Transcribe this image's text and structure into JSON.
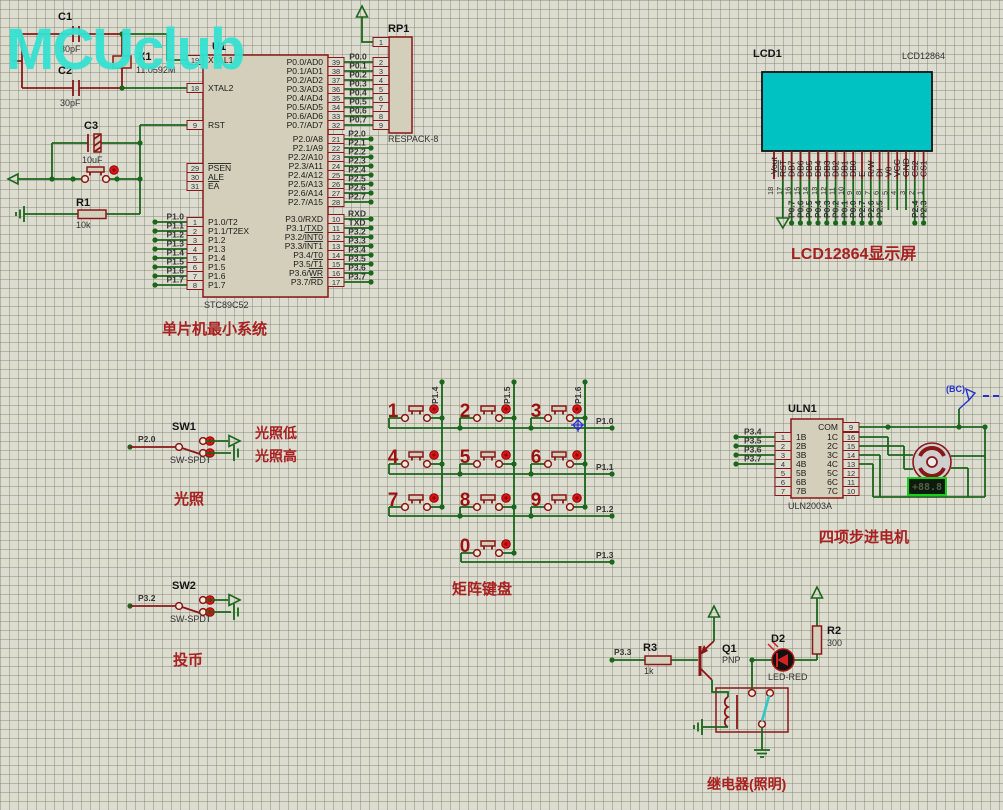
{
  "watermark": "MCUclub",
  "titles": {
    "mcu": "单片机最小系统",
    "lcd": "LCD12864显示屏",
    "keypad": "矩阵键盘",
    "stepper": "四项步进电机",
    "light": "光照",
    "light_low": "光照低",
    "light_high": "光照高",
    "coin": "投币",
    "relay": "继电器(照明)"
  },
  "mcu": {
    "ref": "U1",
    "part": "STC89C52",
    "ctrl_pins": [
      {
        "num": "19",
        "name": "XTAL1"
      },
      {
        "num": "18",
        "name": "XTAL2"
      },
      {
        "num": "9",
        "name": "RST"
      },
      {
        "num": "29",
        "name": "|PSEN"
      },
      {
        "num": "30",
        "name": "ALE"
      },
      {
        "num": "31",
        "name": "|EA"
      }
    ],
    "p1_pins": [
      {
        "num": "1",
        "name": "P1.0/T2",
        "net": "P1.0"
      },
      {
        "num": "2",
        "name": "P1.1/T2EX",
        "net": "P1.1"
      },
      {
        "num": "3",
        "name": "P1.2",
        "net": "P1.2"
      },
      {
        "num": "4",
        "name": "P1.3",
        "net": "P1.3"
      },
      {
        "num": "5",
        "name": "P1.4",
        "net": "P1.4"
      },
      {
        "num": "6",
        "name": "P1.5",
        "net": "P1.5"
      },
      {
        "num": "7",
        "name": "P1.6",
        "net": "P1.6"
      },
      {
        "num": "8",
        "name": "P1.7",
        "net": "P1.7"
      }
    ],
    "p0_pins": [
      {
        "num": "39",
        "name": "P0.0/AD0",
        "net": "P0.0",
        "rp": "2"
      },
      {
        "num": "38",
        "name": "P0.1/AD1",
        "net": "P0.1",
        "rp": "3"
      },
      {
        "num": "37",
        "name": "P0.2/AD2",
        "net": "P0.2",
        "rp": "4"
      },
      {
        "num": "36",
        "name": "P0.3/AD3",
        "net": "P0.3",
        "rp": "5"
      },
      {
        "num": "35",
        "name": "P0.4/AD4",
        "net": "P0.4",
        "rp": "6"
      },
      {
        "num": "34",
        "name": "P0.5/AD5",
        "net": "P0.5",
        "rp": "7"
      },
      {
        "num": "33",
        "name": "P0.6/AD6",
        "net": "P0.6",
        "rp": "8"
      },
      {
        "num": "32",
        "name": "P0.7/AD7",
        "net": "P0.7",
        "rp": "9"
      }
    ],
    "p2_pins": [
      {
        "num": "21",
        "name": "P2.0/A8",
        "net": "P2.0"
      },
      {
        "num": "22",
        "name": "P2.1/A9",
        "net": "P2.1"
      },
      {
        "num": "23",
        "name": "P2.2/A10",
        "net": "P2.2"
      },
      {
        "num": "24",
        "name": "P2.3/A11",
        "net": "P2.3"
      },
      {
        "num": "25",
        "name": "P2.4/A12",
        "net": "P2.4"
      },
      {
        "num": "26",
        "name": "P2.5/A13",
        "net": "P2.5"
      },
      {
        "num": "27",
        "name": "P2.6/A14",
        "net": "P2.6"
      },
      {
        "num": "28",
        "name": "P2.7/A15",
        "net": "P2.7"
      }
    ],
    "p3_pins": [
      {
        "num": "10",
        "name": "P3.0/RXD",
        "net": "RXD"
      },
      {
        "num": "11",
        "name": "P3.1/TXD",
        "net": "TXD"
      },
      {
        "num": "12",
        "name": "P3.2/|INT0",
        "net": "P3.2"
      },
      {
        "num": "13",
        "name": "P3.3/|INT1",
        "net": "P3.3"
      },
      {
        "num": "14",
        "name": "P3.4/T0",
        "net": "P3.4"
      },
      {
        "num": "15",
        "name": "P3.5/|T1",
        "net": "P3.5"
      },
      {
        "num": "16",
        "name": "P3.6/|WR",
        "net": "P3.6"
      },
      {
        "num": "17",
        "name": "P3.7/|RD",
        "net": "P3.7"
      }
    ]
  },
  "rp1": {
    "ref": "RP1",
    "part": "RESPACK-8",
    "pin1": "1"
  },
  "parts": {
    "c1": {
      "ref": "C1",
      "value": "30pF"
    },
    "c2": {
      "ref": "C2",
      "value": "30pF"
    },
    "c3": {
      "ref": "C3",
      "value": "10uF"
    },
    "x1": {
      "ref": "X1",
      "value": "11.0592M"
    },
    "r1": {
      "ref": "R1",
      "value": "10k"
    },
    "r2": {
      "ref": "R2",
      "value": "300"
    },
    "r3": {
      "ref": "R3",
      "value": "1k"
    },
    "q1": {
      "ref": "Q1",
      "value": "PNP"
    },
    "d2": {
      "ref": "D2",
      "value": "LED-RED"
    }
  },
  "lcd": {
    "ref": "LCD1",
    "part": "LCD12864",
    "pins": [
      {
        "num": "18",
        "name": "-Vout",
        "net": "",
        "wire": "none"
      },
      {
        "num": "17",
        "name": "|RST",
        "net": "",
        "wire": "gnd"
      },
      {
        "num": "16",
        "name": "DB7",
        "net": "P0.7",
        "wire": "net"
      },
      {
        "num": "15",
        "name": "DB6",
        "net": "P0.6",
        "wire": "net"
      },
      {
        "num": "14",
        "name": "DB5",
        "net": "P0.5",
        "wire": "net"
      },
      {
        "num": "13",
        "name": "DB4",
        "net": "P0.4",
        "wire": "net"
      },
      {
        "num": "12",
        "name": "DB3",
        "net": "P0.3",
        "wire": "net"
      },
      {
        "num": "11",
        "name": "DB2",
        "net": "P0.2",
        "wire": "net"
      },
      {
        "num": "10",
        "name": "DB1",
        "net": "P0.1",
        "wire": "net"
      },
      {
        "num": "9",
        "name": "DB0",
        "net": "P0.0",
        "wire": "net"
      },
      {
        "num": "8",
        "name": "E",
        "net": "P2.7",
        "wire": "net"
      },
      {
        "num": "7",
        "name": "R/W",
        "net": "P2.6",
        "wire": "net"
      },
      {
        "num": "6",
        "name": "DI",
        "net": "P2.5",
        "wire": "net"
      },
      {
        "num": "5",
        "name": "V0",
        "net": "",
        "wire": "open"
      },
      {
        "num": "4",
        "name": "VCC",
        "net": "",
        "wire": "open"
      },
      {
        "num": "3",
        "name": "GND",
        "net": "",
        "wire": "open"
      },
      {
        "num": "2",
        "name": "CS2",
        "net": "P2.4",
        "wire": "net"
      },
      {
        "num": "1",
        "name": "CS1",
        "net": "P2.3",
        "wire": "net"
      }
    ]
  },
  "keypad": {
    "keys": [
      {
        "label": "1",
        "r": 0,
        "c": 0
      },
      {
        "label": "2",
        "r": 0,
        "c": 1
      },
      {
        "label": "3",
        "r": 0,
        "c": 2
      },
      {
        "label": "4",
        "r": 1,
        "c": 0
      },
      {
        "label": "5",
        "r": 1,
        "c": 1
      },
      {
        "label": "6",
        "r": 1,
        "c": 2
      },
      {
        "label": "7",
        "r": 2,
        "c": 0
      },
      {
        "label": "8",
        "r": 2,
        "c": 1
      },
      {
        "label": "9",
        "r": 2,
        "c": 2
      },
      {
        "label": "0",
        "r": 3,
        "c": 1
      }
    ],
    "row_nets": [
      "P1.0",
      "P1.1",
      "P1.2",
      "P1.3"
    ],
    "col_nets": [
      "P1.4",
      "P1.5",
      "P1.6"
    ]
  },
  "uln": {
    "ref": "ULN1",
    "part": "ULN2003A",
    "left": [
      {
        "num": "1",
        "name": "1B",
        "net": "P3.4"
      },
      {
        "num": "2",
        "name": "2B",
        "net": "P3.5"
      },
      {
        "num": "3",
        "name": "3B",
        "net": "P3.6"
      },
      {
        "num": "4",
        "name": "4B",
        "net": "P3.7"
      },
      {
        "num": "5",
        "name": "5B",
        "net": ""
      },
      {
        "num": "6",
        "name": "6B",
        "net": ""
      },
      {
        "num": "7",
        "name": "7B",
        "net": ""
      }
    ],
    "right": [
      {
        "num": "9",
        "name": "COM"
      },
      {
        "num": "16",
        "name": "1C"
      },
      {
        "num": "15",
        "name": "2C"
      },
      {
        "num": "14",
        "name": "3C"
      },
      {
        "num": "13",
        "name": "4C"
      },
      {
        "num": "12",
        "name": "5C"
      },
      {
        "num": "11",
        "name": "6C"
      },
      {
        "num": "10",
        "name": "7C"
      }
    ]
  },
  "motor": {
    "display": "+88.8",
    "probe_label": "(BC)"
  },
  "switches": [
    {
      "ref": "SW1",
      "part": "SW-SPDT",
      "net": "P2.0"
    },
    {
      "ref": "SW2",
      "part": "SW-SPDT",
      "net": "P3.2"
    }
  ],
  "relay_net": "P3.3",
  "colors": {
    "wire_green": "#1a661a",
    "component_red": "#8a1717",
    "lcd_screen": "#00c2c2",
    "watermark": "#35e2d2",
    "title_red": "#a82020",
    "probe_blue": "#2233cc"
  }
}
